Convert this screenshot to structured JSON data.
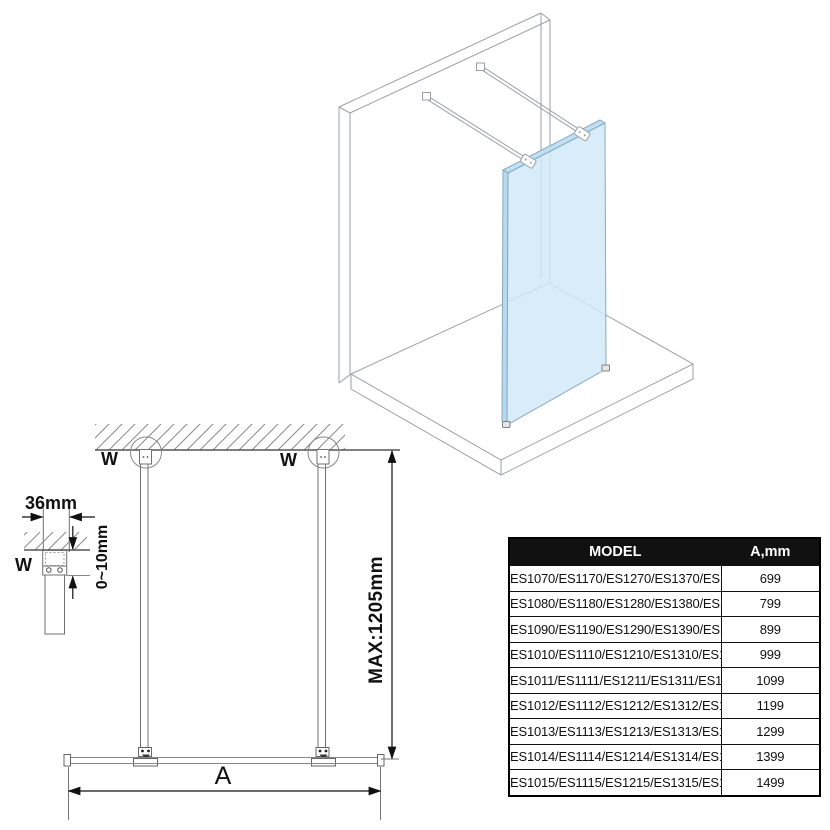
{
  "diagram": {
    "labels": {
      "wall_mount_left": "W",
      "wall_mount_right": "W",
      "wall_mount_detail": "W",
      "bar_width": "36mm",
      "gap_range": "0~10mm",
      "max_height": "MAX:1205mm",
      "width_dim": "A"
    },
    "colors": {
      "glass_fill": "#cfe9f8",
      "glass_edge": "#8aa9c0",
      "line_art": "#9aa0a6",
      "dimension": "#111111"
    }
  },
  "table": {
    "headers": {
      "model": "MODEL",
      "a_mm": "A,mm"
    },
    "rows": [
      {
        "model": "ES1070/ES1170/ES1270/ES1370/ES1570",
        "a_mm": "699"
      },
      {
        "model": "ES1080/ES1180/ES1280/ES1380/ES1580",
        "a_mm": "799"
      },
      {
        "model": "ES1090/ES1190/ES1290/ES1390/ES1590",
        "a_mm": "899"
      },
      {
        "model": "ES1010/ES1110/ES1210/ES1310/ES1510",
        "a_mm": "999"
      },
      {
        "model": "ES1011/ES1111/ES1211/ES1311/ES1511",
        "a_mm": "1099"
      },
      {
        "model": "ES1012/ES1112/ES1212/ES1312/ES1512",
        "a_mm": "1199"
      },
      {
        "model": "ES1013/ES1113/ES1213/ES1313/ES1513",
        "a_mm": "1299"
      },
      {
        "model": "ES1014/ES1114/ES1214/ES1314/ES1514",
        "a_mm": "1399"
      },
      {
        "model": "ES1015/ES1115/ES1215/ES1315/ES1515",
        "a_mm": "1499"
      }
    ]
  }
}
